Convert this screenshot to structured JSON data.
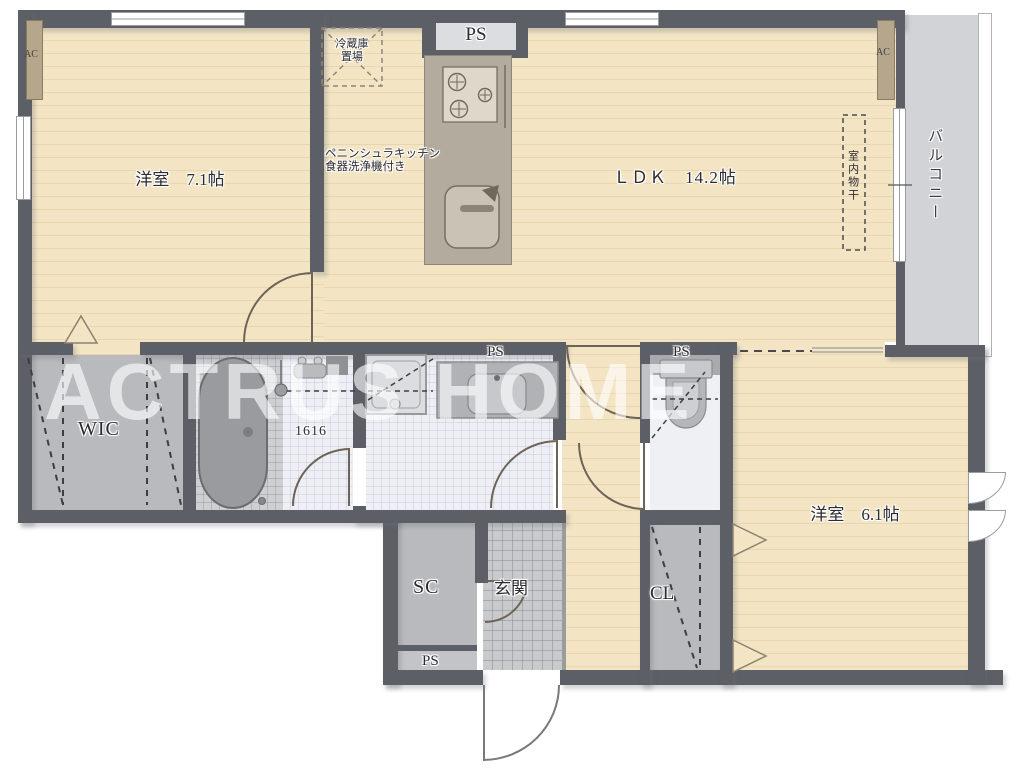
{
  "watermark": "ACTRUS HOME",
  "rooms": {
    "bedroom_main": "洋室　7.1帖",
    "ldk": "ＬＤＫ　14.2帖",
    "bedroom_second": "洋室　6.1帖",
    "balcony": "バルコニー",
    "walk_in_closet": "WIC",
    "shoe_closet": "SC",
    "closet": "CL",
    "entrance": "玄関"
  },
  "labels": {
    "ps": "PS",
    "ac": "AC",
    "bath_unit_size": "1616",
    "fridge_space_line1": "冷蔵庫",
    "fridge_space_line2": "置場",
    "kitchen_note_line1": "ペニンシュラキッチン",
    "kitchen_note_line2": "食器洗浄機付き",
    "indoor_laundry": "室内物干"
  },
  "colors": {
    "wall": "#5c5f66",
    "wood_floor": "#f3e5c4",
    "wood_plank_line": "#e7d6af",
    "closet_gray": "#b9babd",
    "balcony_gray": "#d2d3d6",
    "entrance_tile_gray": "#c9cacc",
    "wet_area_white": "#edeff4",
    "kitchen_counter_tan": "#b2ab9e",
    "fixture_gray": "#c6c8cc"
  }
}
